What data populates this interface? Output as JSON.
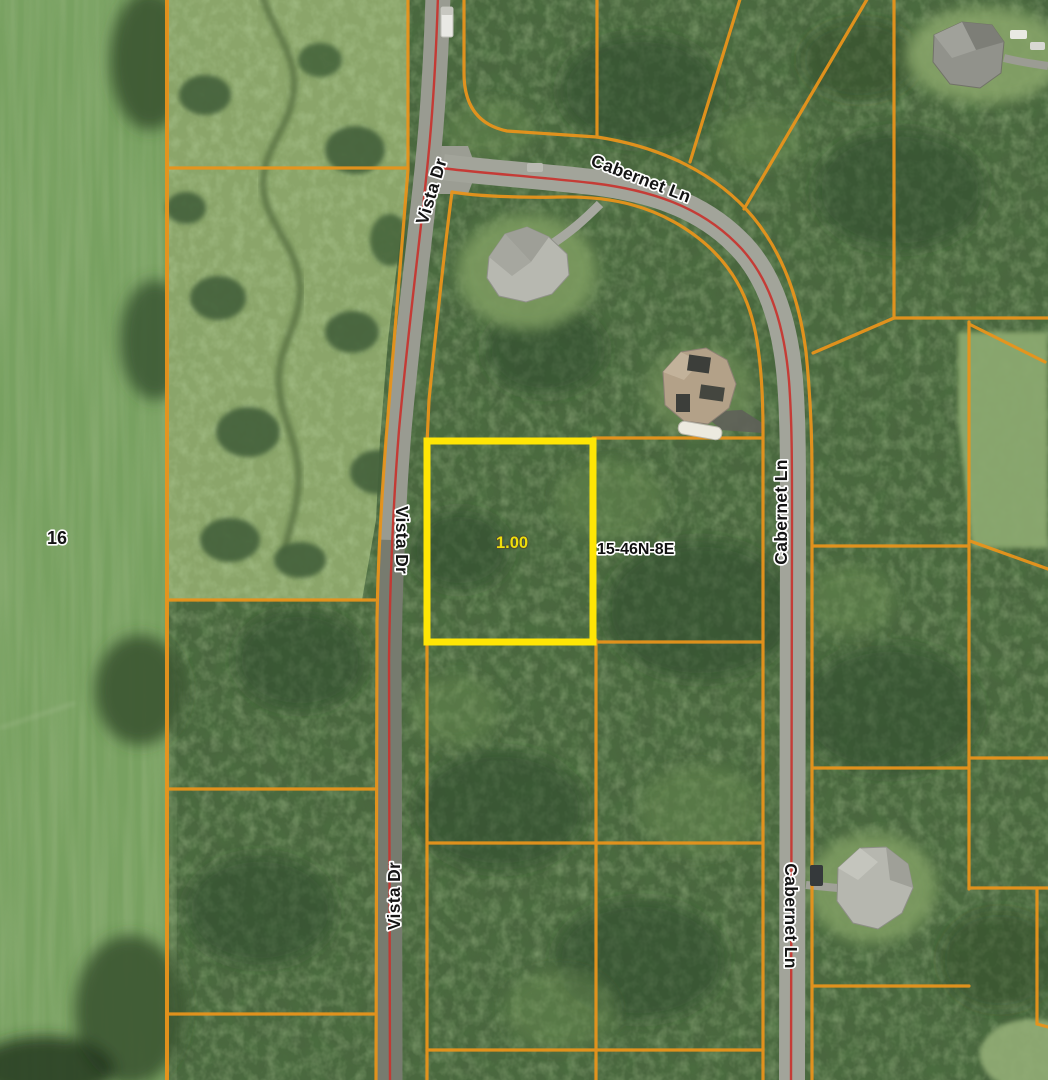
{
  "map": {
    "labels": {
      "section_number": "16",
      "parcel_acreage": "1.00",
      "section_township_range": "15-46N-8E"
    },
    "road_labels": [
      {
        "id": "vista-dr-top",
        "text": "Vista Dr"
      },
      {
        "id": "vista-dr-middle",
        "text": "Vista Dr"
      },
      {
        "id": "vista-dr-bottom",
        "text": "Vista Dr"
      },
      {
        "id": "cabernet-ln-top",
        "text": "Cabernet Ln"
      },
      {
        "id": "cabernet-ln-right-upper",
        "text": "Cabernet Ln"
      },
      {
        "id": "cabernet-ln-right-lower",
        "text": "Cabernet Ln"
      }
    ],
    "colors": {
      "parcel_boundary": "#E8941C",
      "road_centerline": "#C8332E",
      "parcel_highlight": "#FFE605",
      "acreage_text": "#F0DE0A",
      "label_text": "#141414",
      "label_halo": "#FFFFFF"
    }
  }
}
